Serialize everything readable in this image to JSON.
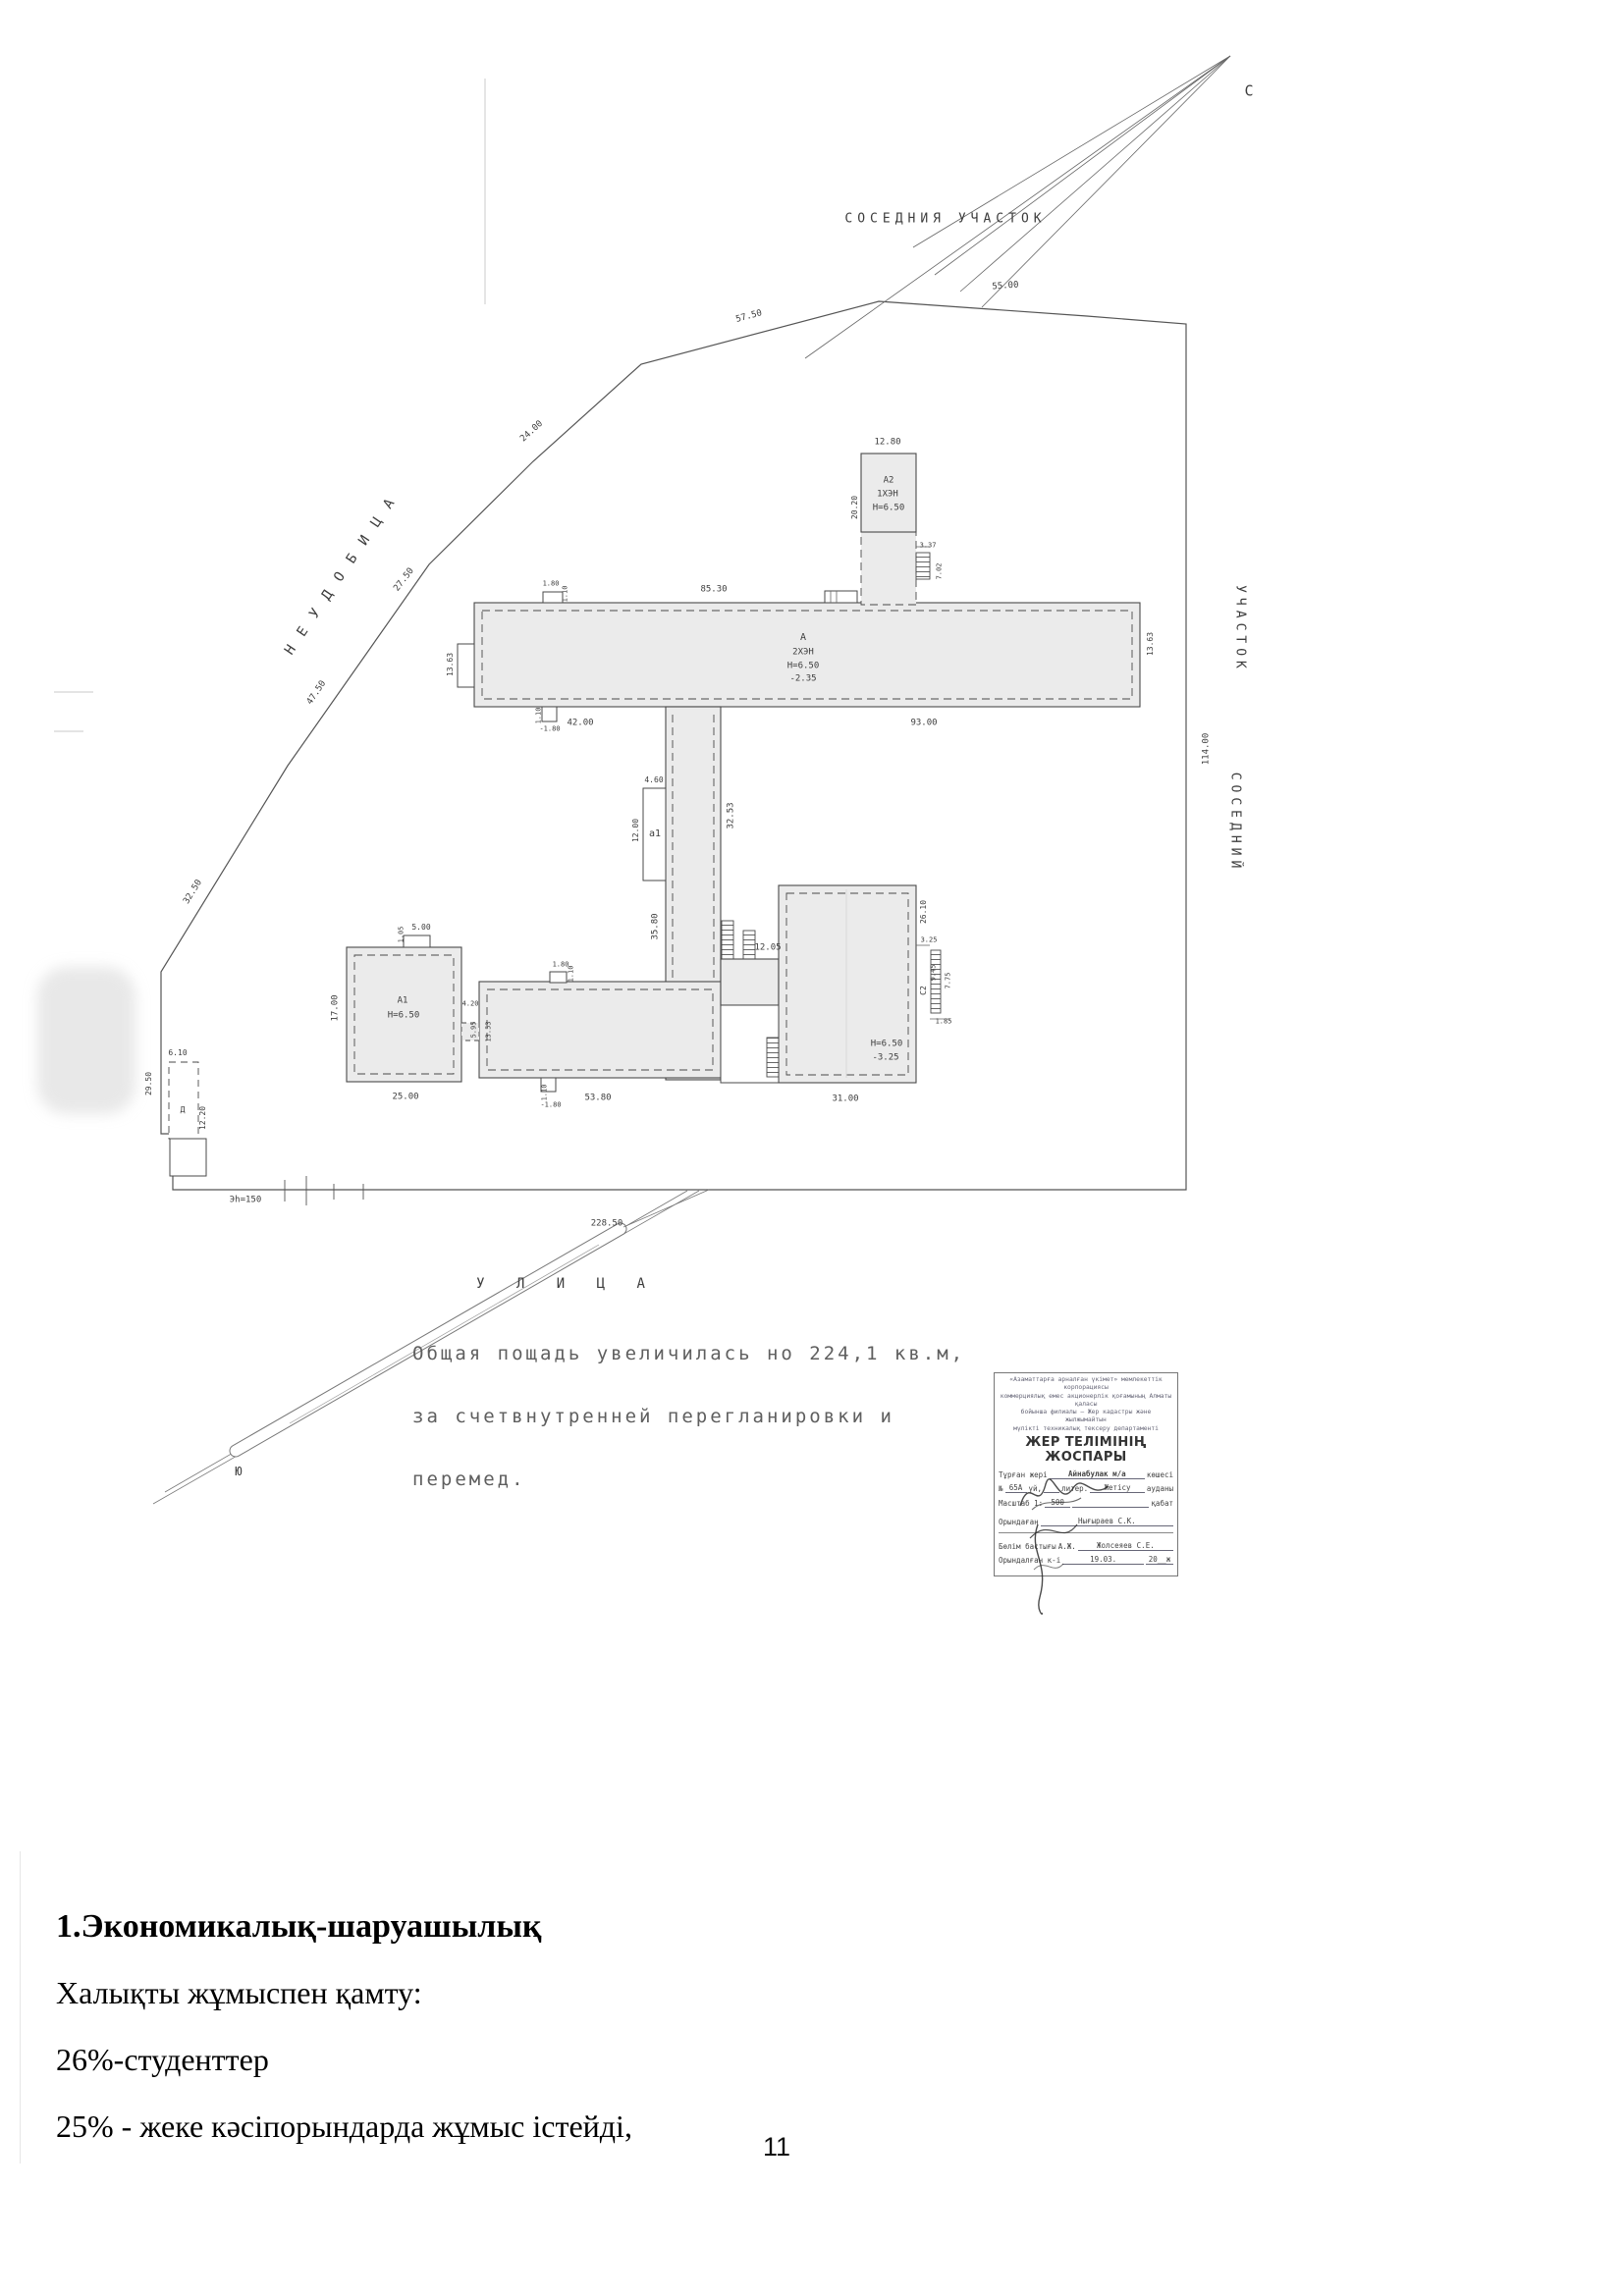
{
  "plan": {
    "north": "С",
    "neighbor_top": "СОСЕДНИЯ  УЧАСТОК",
    "neighbor_right_upper": "УЧАСТОК",
    "neighbor_right_lower": "СОСЕДНИЙ",
    "wasteland": "НЕУДОБИЦА",
    "street": "У Л И Ц А",
    "south": "Ю",
    "power_line": "Эh=150",
    "site_dims": {
      "top": "55.00",
      "seg_57": "57.50",
      "seg_24": "24.00",
      "seg_27": "27.50",
      "seg_47": "47.50",
      "seg_32": "32.50",
      "right": "114.00",
      "bottom": "228.50"
    },
    "bldg_a": {
      "label": "А",
      "floors": "2ХЭН",
      "height": "Н=6.50",
      "elev": "-2.35",
      "dim_top": "85.30",
      "dim_bottom_left": "42.00",
      "dim_bottom_right": "93.00",
      "dim_side_left": "13.63",
      "dim_side_right": "13.63",
      "porch_w": "1.80",
      "porch_d": "1.10",
      "notch_d": "1.10",
      "notch_w": "-1.80"
    },
    "bldg_a2": {
      "label": "А2",
      "floors": "1ХЭН",
      "height": "Н=6.50",
      "dim_top": "12.80",
      "dim_side": "20.20",
      "stair_w": "3.37",
      "stair_d": "7.02"
    },
    "corridor": {
      "annex": "а1",
      "annex_w": "4.60",
      "annex_d": "12.00",
      "dim_left": "35.80",
      "dim_right": "32.53",
      "stair": "12.05"
    },
    "bldg_a1": {
      "label": "А1",
      "height": "Н=6.50",
      "dim_bottom": "25.00",
      "dim_side": "17.00",
      "porch_w": "5.00",
      "porch_d": "1.05"
    },
    "link": {
      "w": "4.20",
      "d1": "5.95",
      "d2": "13.53"
    },
    "bldg_lower": {
      "dim_bottom": "53.80",
      "porch_w": "1.80",
      "porch_d": "1.10",
      "notch_d": "1.10",
      "notch_w": "-1.80"
    },
    "bldg_right": {
      "height": "Н=6.50",
      "elev": "-3.25",
      "dim_bottom": "31.00",
      "dim_side": "26.10",
      "s_325": "3.25",
      "s_945": "9.45",
      "s_775": "7.75",
      "s_c2": "С2",
      "s_185": "1.85"
    },
    "shed": {
      "dim_top": "6.10",
      "dim_left": "29.50",
      "dim_right": "12.20",
      "mark": "Д"
    }
  },
  "note": {
    "line1": "Общая пощадь увеличилась но 224,1 кв.м,",
    "line2": "за счетвнутренней перегланировки и",
    "line3": "перемед."
  },
  "stamp": {
    "header1": "«Азаматтарға арналған үкімет» мемлекеттік корпорациясы",
    "header2": "коммерциялық емес акционерлік қоғамының Алматы қаласы",
    "header3": "бойынша филиалы – Жер кадастры және жылжымайтын",
    "header4": "мүлікті техникалық тексеру департаменті",
    "title": "ЖЕР ТЕЛІМІНІҢ ЖОСПАРЫ",
    "f1_label": "Тұрған жері",
    "f1_value": "Айнабулак м/а",
    "f1_suffix": "көшесі",
    "f2_no": "№",
    "f2_house": "65А",
    "f2_uy": "үй,",
    "f2_liter": "литер.",
    "f2_district": "Жетісу",
    "f2_suffix": "ауданы",
    "f3_label": "Масштаб 1:",
    "f3_value": "500",
    "f3_suffix": "қабат",
    "f4_label": "Орындаған",
    "f4_value": "Нығыраев С.К.",
    "f5_label": "Бөлім бастығы",
    "f5_prefix": "А.Ж.",
    "f5_value": "Жолсеяев С.Е.",
    "f6_label": "Орындалған к-і",
    "f6_date": "19.03.",
    "f6_year": "20__ж"
  },
  "body": {
    "heading": "1.Экономикалық-шаруашылық",
    "line1": "Халықты жұмыспен қамту:",
    "line2": "26%-студенттер",
    "line3": "25% - жеке кәсіпорындарда жұмыс істейді,",
    "page_number": "11"
  }
}
